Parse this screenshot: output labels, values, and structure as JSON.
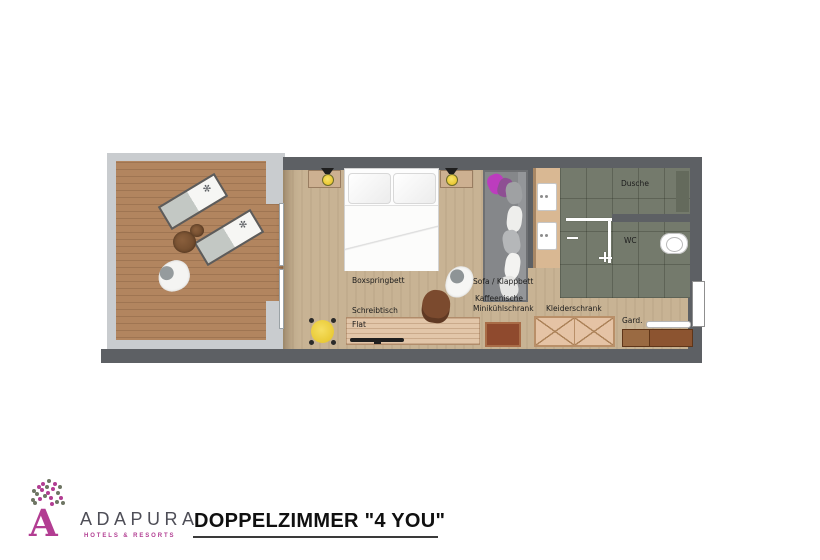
{
  "page": {
    "background": "#ffffff"
  },
  "floorplan": {
    "labels": {
      "bed": "Boxspringbett",
      "sofa": "Sofa / Klappbett",
      "coffee1": "Kaffeenische",
      "coffee2": "Minikühlschrank",
      "desk": "Schreibtisch",
      "tv": "Flat",
      "wardrobe": "Kleiderschrank",
      "coatrack": "Gard.",
      "shower": "Dusche",
      "wc": "WC"
    },
    "colors": {
      "wall": "#5d6064",
      "parapet": "#c9cccf",
      "terrace_deck": "#b2855f",
      "room_floor": "#c8b394",
      "bath_tile": "#747a6c",
      "furniture_wood": "#e2c6a9",
      "lamp_yellow": "#f1d23f",
      "pillow_magenta": "#bc3cbe",
      "cabinet_brown": "#8f4a2e"
    }
  },
  "footer": {
    "brand_name": "ADAPURA",
    "brand_tagline": "HOTELS & RESORTS",
    "room_title": "DOPPELZIMMER  \"4 YOU\""
  }
}
